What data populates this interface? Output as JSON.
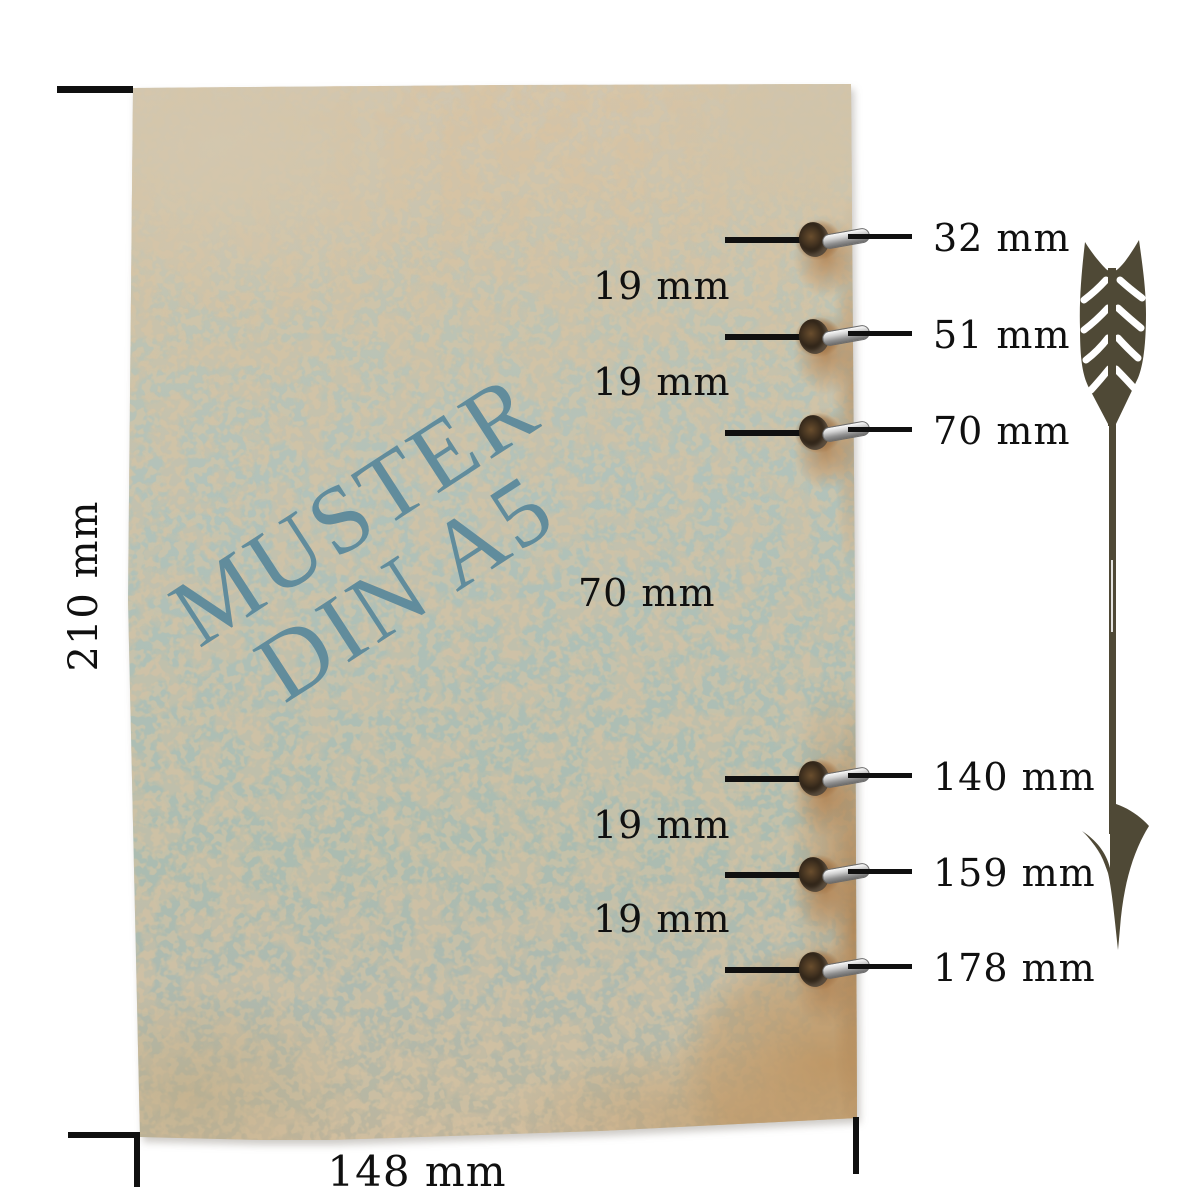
{
  "watermark": {
    "line1": "MUSTER",
    "line2": "DIN A5"
  },
  "dimensions": {
    "height_label": "210 mm",
    "width_label": "148 mm"
  },
  "holes": [
    {
      "label": "32 mm"
    },
    {
      "label": "51 mm"
    },
    {
      "label": "70 mm"
    },
    {
      "label": "140 mm"
    },
    {
      "label": "159 mm"
    },
    {
      "label": "178 mm"
    }
  ],
  "gaps": [
    {
      "label": "19 mm"
    },
    {
      "label": "19 mm"
    },
    {
      "label": "70 mm"
    },
    {
      "label": "19 mm"
    },
    {
      "label": "19 mm"
    }
  ],
  "icons": {
    "arrow": "hand-drawn-arrow-down"
  },
  "colors": {
    "paper-teal": "#aebfb6",
    "paper-beige": "#d1c6b0",
    "stain-tan": "#bf9a6b",
    "watermark-blue": "#5a889b",
    "arrow-olive": "#4f4936",
    "line-black": "#101010",
    "metal-silver": "#c9c9c9"
  }
}
